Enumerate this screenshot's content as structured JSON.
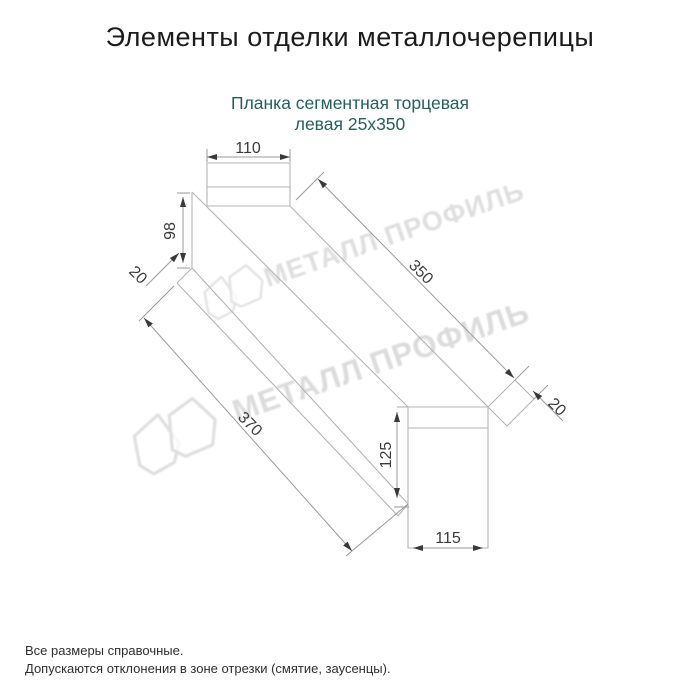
{
  "title": "Элементы отделки металлочерепицы",
  "subtitle": {
    "line1": "Планка сегментная торцевая",
    "line2": "левая 25х350"
  },
  "dimensions": {
    "top_width": "110",
    "left_height": "98",
    "left_fold": "20",
    "top_length": "350",
    "right_fold": "20",
    "bottom_length": "370",
    "right_height": "125",
    "bottom_width": "115"
  },
  "watermark": {
    "text": "МЕТАЛЛ ПРОФИЛЬ"
  },
  "footer": {
    "line1": "Все размеры справочные.",
    "line2": "Допускаются отклонения в зоне отрезки (смятие, заусенцы)."
  },
  "colors": {
    "title": "#1b1b1b",
    "subtitle": "#235f5b",
    "outline": "#b4b4b4",
    "dim_line": "#9a9a9a",
    "dim_text": "#3a3a3a",
    "arrow": "#3a3a3a",
    "watermark_stroke": "#c9c9c9",
    "watermark_text": "#c4c4c4",
    "footer": "#2f2f2f",
    "background": "#ffffff"
  }
}
